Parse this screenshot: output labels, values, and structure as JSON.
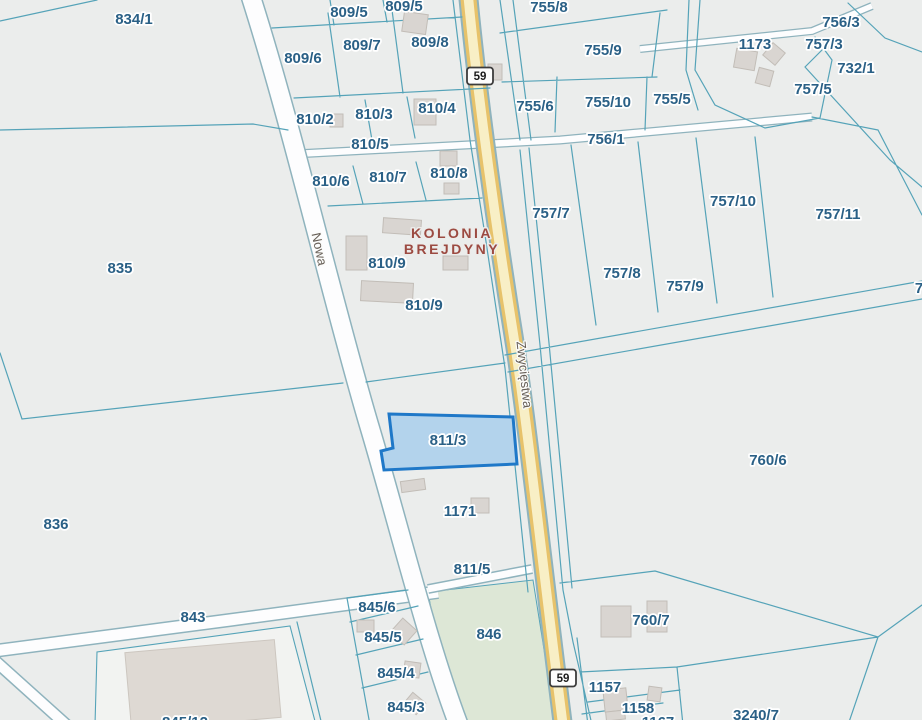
{
  "map": {
    "type": "cadastral-parcel-map",
    "colors": {
      "line": "#55a3b8",
      "casing": "#8fb3bd",
      "yellowBorder": "#e7c26a",
      "yellowFill": "#f8efc6",
      "green": "#dde7d6",
      "building": "#d9d5d1",
      "buildingEdge": "#c2bdb7",
      "label": "#2a6086",
      "street": "#665e56",
      "locality": "#9c4a41",
      "hlFill": "#b3d3ec",
      "hlStroke": "#1f78c8",
      "background": "#ebedec"
    },
    "selected_parcel": {
      "id": "811/3"
    },
    "locality": {
      "line1": "KOLONIA",
      "line2": "BREJDYNY",
      "x": 452,
      "y1": 238,
      "y2": 254
    },
    "streets": [
      {
        "name": "Nowa",
        "x": 315,
        "y": 250,
        "rotate": 78
      },
      {
        "name": "Zwycięstwa",
        "x": 520,
        "y": 375,
        "rotate": 84
      }
    ],
    "route_shields": [
      {
        "number": "59",
        "x": 480,
        "y": 76
      },
      {
        "number": "59",
        "x": 563,
        "y": 678
      }
    ],
    "parcel_labels": [
      {
        "t": "834/1",
        "x": 134,
        "y": 24
      },
      {
        "t": "809/5",
        "x": 349,
        "y": 17
      },
      {
        "t": "809/5",
        "x": 404,
        "y": 11
      },
      {
        "t": "755/8",
        "x": 549,
        "y": 12
      },
      {
        "t": "756/3",
        "x": 841,
        "y": 27
      },
      {
        "t": "1173",
        "x": 755,
        "y": 49
      },
      {
        "t": "757/3",
        "x": 824,
        "y": 49
      },
      {
        "t": "732/1",
        "x": 856,
        "y": 73
      },
      {
        "t": "757/5",
        "x": 813,
        "y": 94
      },
      {
        "t": "809/6",
        "x": 303,
        "y": 63
      },
      {
        "t": "809/7",
        "x": 362,
        "y": 50
      },
      {
        "t": "809/8",
        "x": 430,
        "y": 47
      },
      {
        "t": "755/9",
        "x": 603,
        "y": 55
      },
      {
        "t": "810/2",
        "x": 315,
        "y": 124
      },
      {
        "t": "810/3",
        "x": 374,
        "y": 119
      },
      {
        "t": "810/4",
        "x": 437,
        "y": 113
      },
      {
        "t": "755/6",
        "x": 535,
        "y": 111
      },
      {
        "t": "755/10",
        "x": 608,
        "y": 107
      },
      {
        "t": "755/5",
        "x": 672,
        "y": 104
      },
      {
        "t": "810/5",
        "x": 370,
        "y": 149
      },
      {
        "t": "756/1",
        "x": 606,
        "y": 144
      },
      {
        "t": "810/6",
        "x": 331,
        "y": 186
      },
      {
        "t": "810/7",
        "x": 388,
        "y": 182
      },
      {
        "t": "810/8",
        "x": 449,
        "y": 178
      },
      {
        "t": "757/7",
        "x": 551,
        "y": 218
      },
      {
        "t": "757/10",
        "x": 733,
        "y": 206
      },
      {
        "t": "757/11",
        "x": 838,
        "y": 219
      },
      {
        "t": "757/8",
        "x": 622,
        "y": 278
      },
      {
        "t": "757/9",
        "x": 685,
        "y": 291
      },
      {
        "t": "7",
        "x": 919,
        "y": 293
      },
      {
        "t": "835",
        "x": 120,
        "y": 273
      },
      {
        "t": "810/9",
        "x": 387,
        "y": 268
      },
      {
        "t": "810/9",
        "x": 424,
        "y": 310
      },
      {
        "t": "811/3",
        "x": 448,
        "y": 445
      },
      {
        "t": "760/6",
        "x": 768,
        "y": 465
      },
      {
        "t": "836",
        "x": 56,
        "y": 529
      },
      {
        "t": "1171",
        "x": 460,
        "y": 516
      },
      {
        "t": "811/5",
        "x": 472,
        "y": 574
      },
      {
        "t": "843",
        "x": 193,
        "y": 622
      },
      {
        "t": "845/6",
        "x": 377,
        "y": 612
      },
      {
        "t": "846",
        "x": 489,
        "y": 639
      },
      {
        "t": "760/7",
        "x": 651,
        "y": 625
      },
      {
        "t": "845/5",
        "x": 383,
        "y": 642
      },
      {
        "t": "845/4",
        "x": 396,
        "y": 678
      },
      {
        "t": "845/3",
        "x": 406,
        "y": 712
      },
      {
        "t": "1157",
        "x": 605,
        "y": 692
      },
      {
        "t": "1158",
        "x": 638,
        "y": 713
      },
      {
        "t": "3240/7",
        "x": 756,
        "y": 720
      },
      {
        "t": "845/12",
        "x": 185,
        "y": 727
      },
      {
        "t": "1167",
        "x": 658,
        "y": 727
      }
    ]
  }
}
